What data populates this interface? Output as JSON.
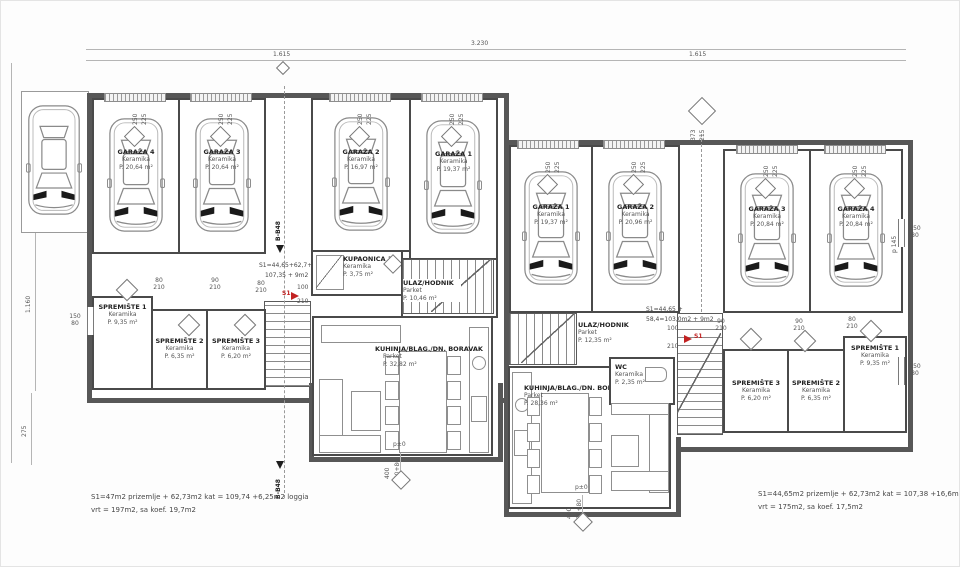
{
  "markers": {
    "section": "B-B48",
    "level": "p±0",
    "unit": "S1"
  },
  "dims": {
    "total": "3.230",
    "half": "1.615",
    "v1160": "1.160",
    "v275": "275",
    "g250": "250",
    "g225": "225",
    "d80": "80",
    "d90": "90",
    "d100": "100",
    "d210": "210",
    "w150": "150",
    "p140": "p 140",
    "p145": "p 145",
    "s373": "373",
    "s215": "215",
    "lvl400": "400",
    "lvl250": "250+80"
  },
  "left_building": {
    "garages": [
      {
        "name": "GARAŽA 4",
        "material": "Keramika",
        "area": "P. 20,64 m²"
      },
      {
        "name": "GARAŽA 3",
        "material": "Keramika",
        "area": "P. 20,64 m²"
      },
      {
        "name": "GARAŽA 2",
        "material": "Keramika",
        "area": "P. 16,97 m²"
      },
      {
        "name": "GARAŽA 1",
        "material": "Keramika",
        "area": "P. 19,37 m²"
      }
    ],
    "bathroom": {
      "name": "KUPAONICA 1",
      "material": "Keramika",
      "area": "P. 3,75 m²"
    },
    "hall": {
      "name": "ULAZ/HODNIK",
      "material": "Parket",
      "area": "P. 10,46 m²"
    },
    "storage": [
      {
        "name": "SPREMIŠTE 1",
        "material": "Keramika",
        "area": "P. 9,35 m²"
      },
      {
        "name": "SPREMIŠTE 2",
        "material": "Keramika",
        "area": "P. 6,35 m²"
      },
      {
        "name": "SPREMIŠTE 3",
        "material": "Keramika",
        "area": "P. 6,20 m²"
      }
    ],
    "living": {
      "name": "KUHINJA/BLAG./DN. BORAVAK",
      "material": "Parket",
      "area": "P. 32,82 m²"
    },
    "note": {
      "line1": "S1=44,65+62,7+",
      "line2": "107,35 + 9m2"
    },
    "summary": {
      "line1": "S1=47m2 prizemlje + 62,73m2 kat = 109,74 +6,25m2 loggia",
      "line2": "vrt = 197m2, sa koef. 19,7m2"
    }
  },
  "right_building": {
    "garages": [
      {
        "name": "GARAŽA 1",
        "material": "Keramika",
        "area": "P. 19,37 m²"
      },
      {
        "name": "GARAŽA 2",
        "material": "Keramika",
        "area": "P. 20,96 m²"
      },
      {
        "name": "GARAŽA 3",
        "material": "Keramika",
        "area": "P. 20,84 m²"
      },
      {
        "name": "GARAŽA 4",
        "material": "Keramika",
        "area": "P. 20,84 m²"
      }
    ],
    "hall": {
      "name": "ULAZ/HODNIK",
      "material": "Parket",
      "area": "P. 12,35 m²"
    },
    "wc": {
      "name": "WC",
      "material": "Keramika",
      "area": "P. 2,35 m²"
    },
    "living": {
      "name": "KUHINJA/BLAG./DN. BORAVAK",
      "material": "Parket",
      "area": "P. 28,36 m²"
    },
    "storage": [
      {
        "name": "SPREMIŠTE 3",
        "material": "Keramika",
        "area": "P. 6,20 m²"
      },
      {
        "name": "SPREMIŠTE 2",
        "material": "Keramika",
        "area": "P. 6,35 m²"
      },
      {
        "name": "SPREMIŠTE 1",
        "material": "Keramika",
        "area": "P. 9,35 m²"
      }
    ],
    "note": {
      "line1": "S1=44,65 +",
      "line2": "58,4=103,0m2 + 9m2"
    },
    "summary": {
      "line1": "S1=44,65m2 prizemlje + 62,73m2 kat = 107,38 +16,6m2 loggia",
      "line2": "vrt = 175m2, sa koef. 17,5m2"
    }
  }
}
